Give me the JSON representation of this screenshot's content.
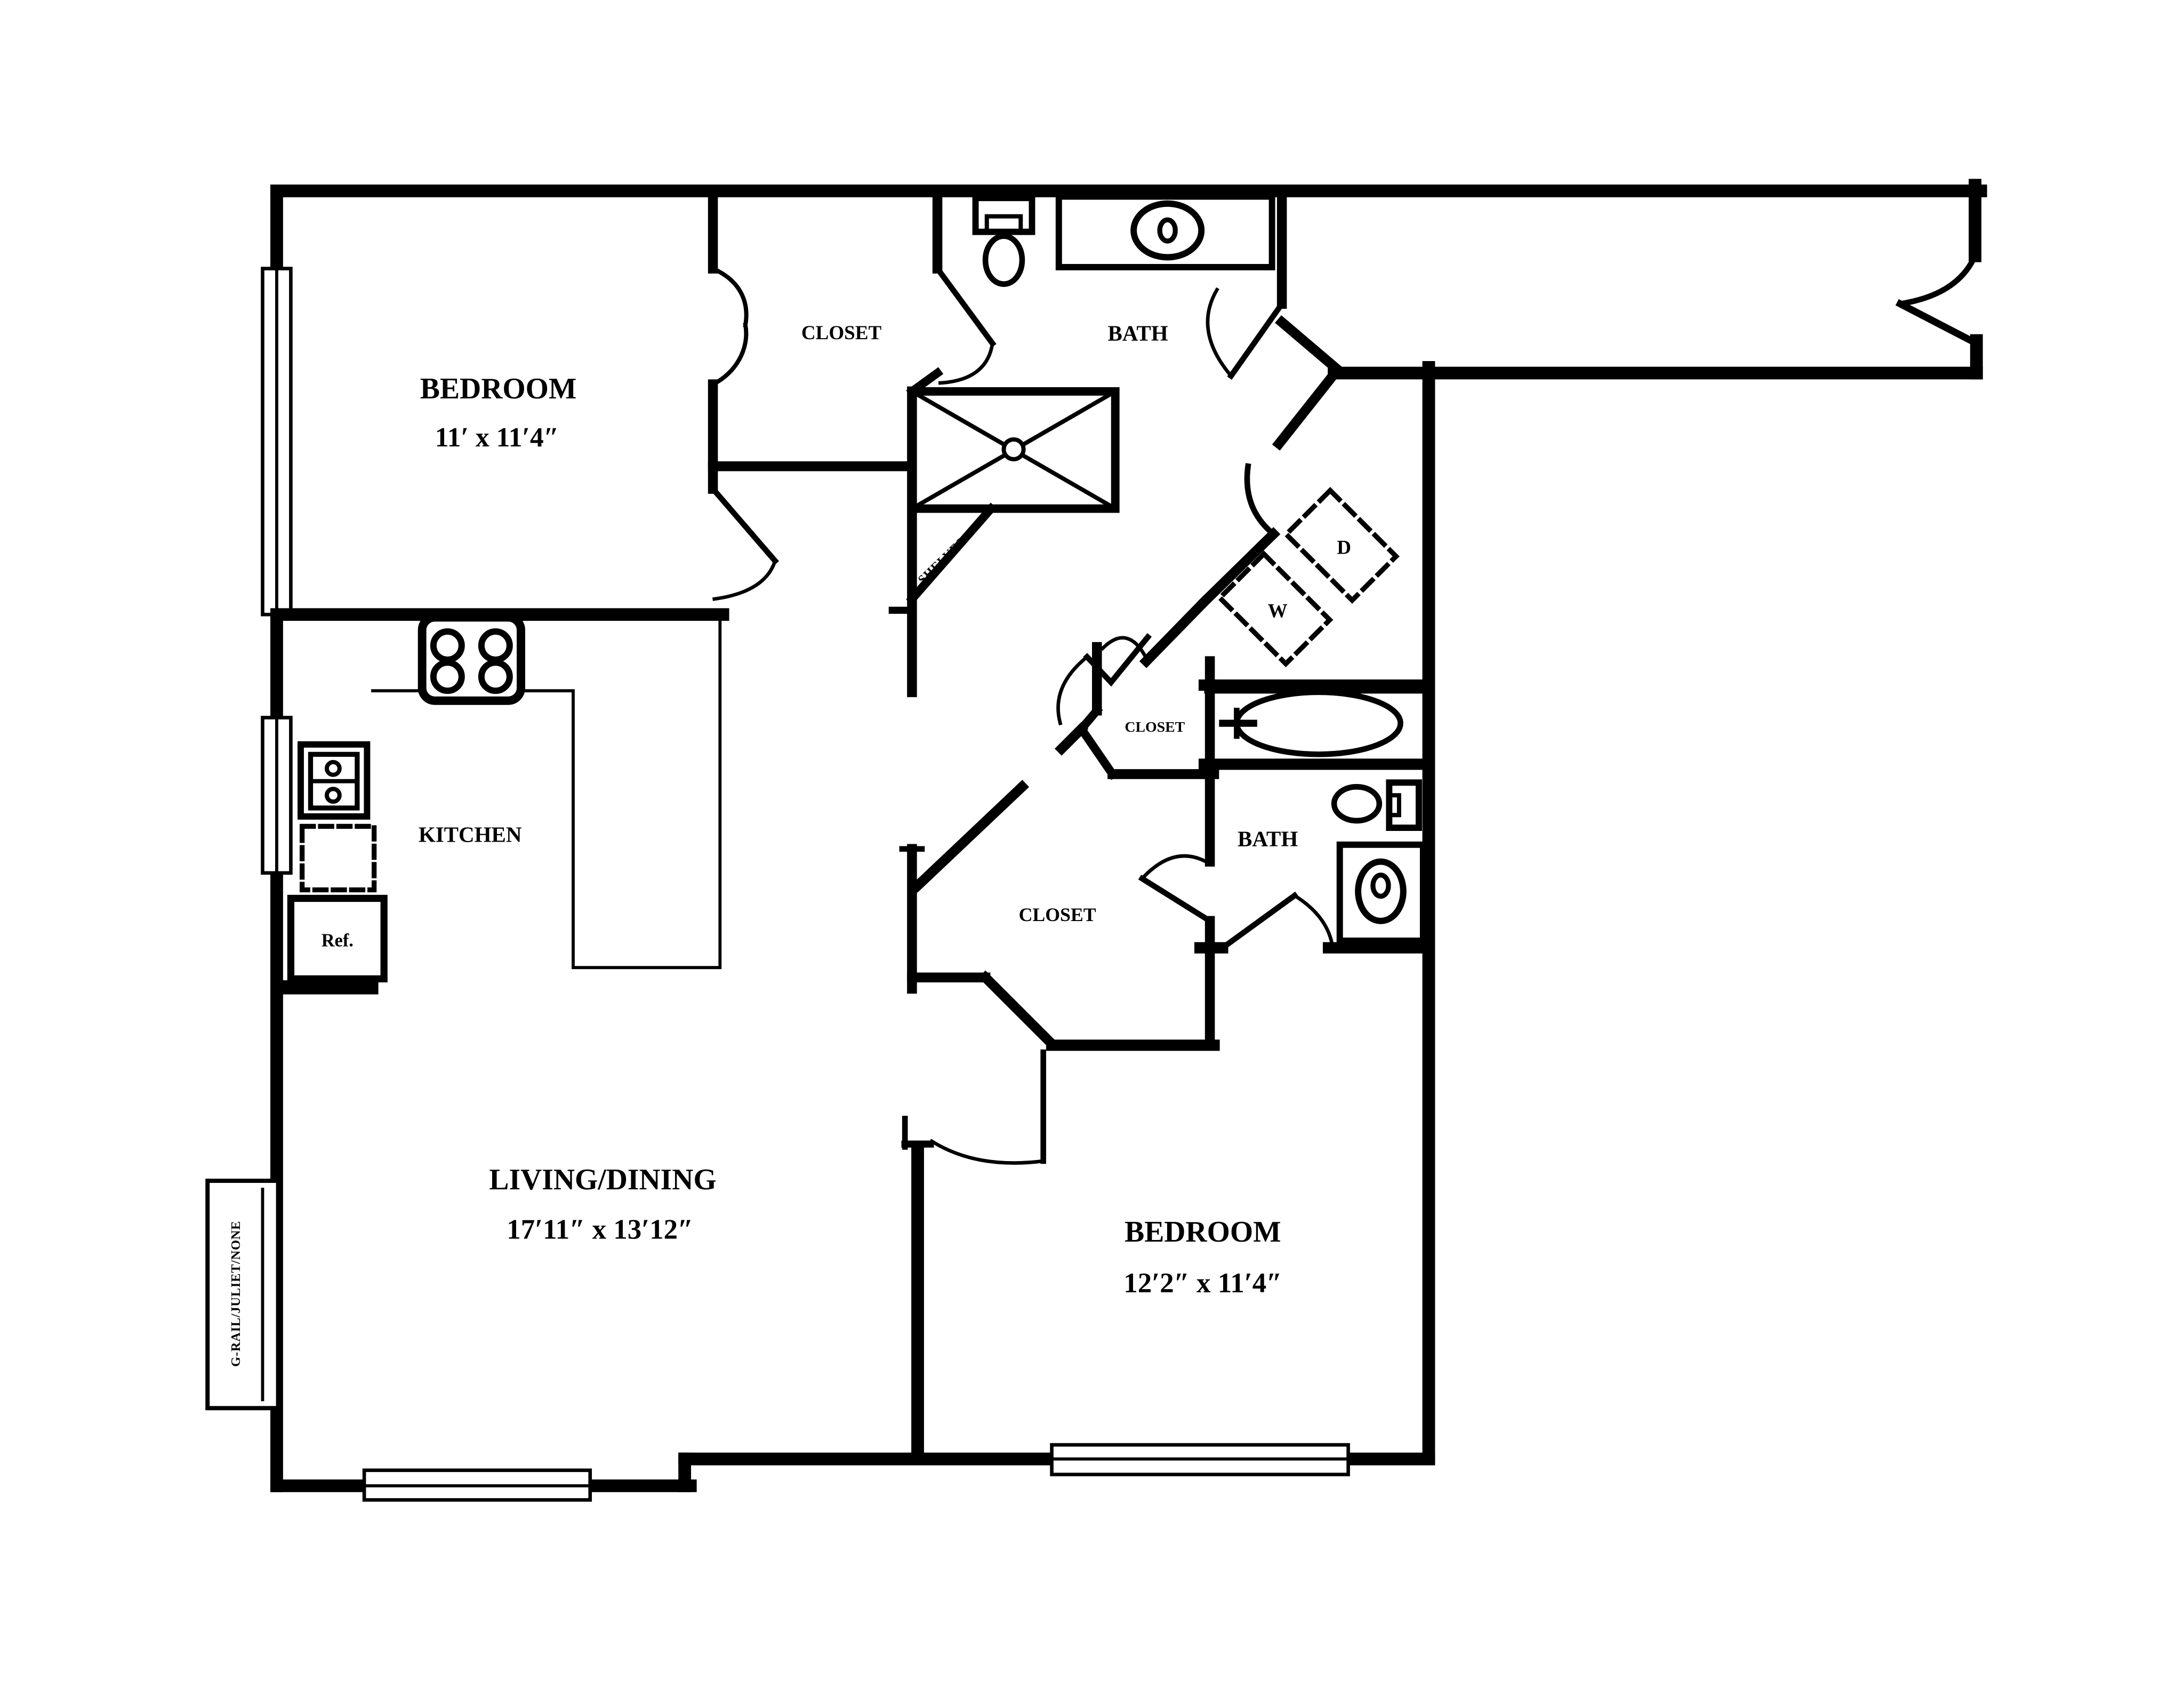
{
  "plan": {
    "bedroom1": {
      "name": "BEDROOM",
      "dims": "11′ x 11′4″"
    },
    "closet1": {
      "name": "CLOSET"
    },
    "bath1": {
      "name": "BATH"
    },
    "kitchen": {
      "name": "KITCHEN"
    },
    "living": {
      "name": "LIVING/DINING",
      "dims": "17′11″ x 13′12″"
    },
    "bedroom2": {
      "name": "BEDROOM",
      "dims": "12′2″ x 11′4″"
    },
    "bath2": {
      "name": "BATH"
    },
    "walkin_closet": {
      "name": "CLOSET"
    },
    "small_closet": {
      "name": "CLOSET"
    },
    "shelves": {
      "label": "SHELVES"
    },
    "refrigerator": {
      "label": "Ref."
    },
    "washer": {
      "label": "W"
    },
    "dryer": {
      "label": "D"
    },
    "balcony_rail": {
      "label": "G-RAIL/JULIET/NONE"
    }
  },
  "colors": {
    "walls": "#000000",
    "background": "#ffffff"
  }
}
